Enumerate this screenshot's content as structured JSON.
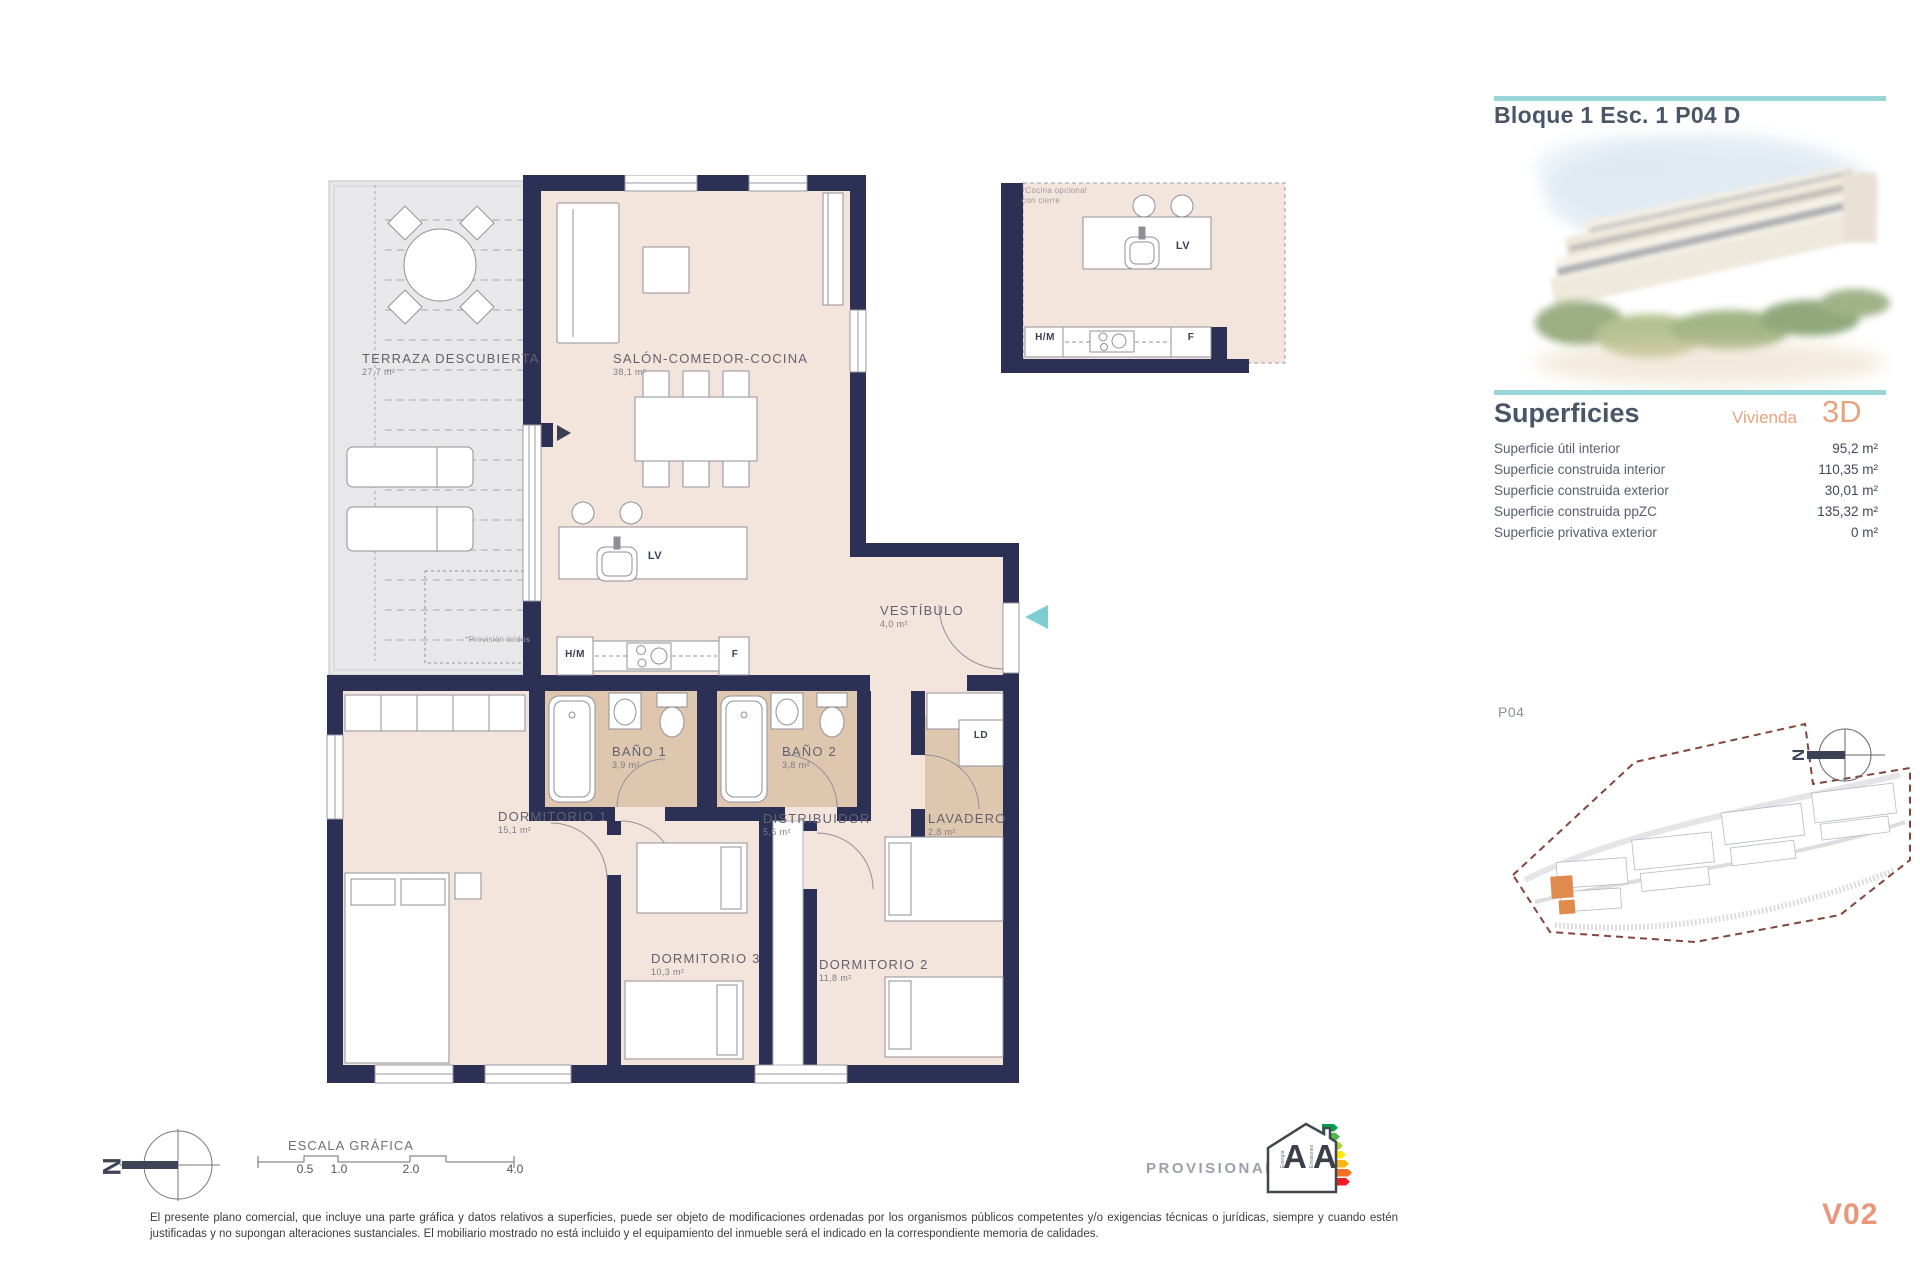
{
  "colors": {
    "wall": "#2b3054",
    "floor": "#f4e5dc",
    "bath_floor": "#dfc7af",
    "terrace": "#e8e8eb",
    "teal_accent": "#9ad6d8",
    "orange_accent": "#e8977c",
    "site_boundary": "#84453b"
  },
  "header": {
    "title": "Bloque 1 Esc. 1 P04 D"
  },
  "superficies": {
    "heading": "Superficies",
    "unit_label": "Vivienda",
    "unit_code": "3D",
    "rows": [
      {
        "label": "Superficie útil interior",
        "value": "95,2 m²"
      },
      {
        "label": "Superficie construida interior",
        "value": "110,35 m²"
      },
      {
        "label": "Superficie construida exterior",
        "value": "30,01 m²"
      },
      {
        "label": "Superficie construida ppZC",
        "value": "135,32 m²"
      },
      {
        "label": "Superficie privativa exterior",
        "value": "0 m²"
      }
    ]
  },
  "floorplan": {
    "rooms": [
      {
        "name": "TERRAZA DESCUBIERTA",
        "area": "27,7 m²"
      },
      {
        "name": "SALÓN-COMEDOR-COCINA",
        "area": "38,1 m²"
      },
      {
        "name": "VESTÍBULO",
        "area": "4,0 m²"
      },
      {
        "name": "BAÑO 1",
        "area": "3,9 m²"
      },
      {
        "name": "BAÑO 2",
        "area": "3,8 m²"
      },
      {
        "name": "DORMITORIO 1",
        "area": "15,1 m²"
      },
      {
        "name": "DISTRIBUIDOR",
        "area": "5,6 m²"
      },
      {
        "name": "LAVADERO",
        "area": "2,8 m²"
      },
      {
        "name": "DORMITORIO 3",
        "area": "10,3 m²"
      },
      {
        "name": "DORMITORIO 2",
        "area": "11,8 m²"
      }
    ],
    "appliances": {
      "lv": "LV",
      "hm": "H/M",
      "f": "F",
      "ld": "LD"
    },
    "terrace_note": "*Previsión toldos",
    "kitchen_note": "*Cocina opcional con cierre"
  },
  "site_plan": {
    "floor_label": "P04"
  },
  "scale_bar": {
    "title": "ESCALA GRÁFICA",
    "ticks": [
      "0.5",
      "1.0",
      "2.0",
      "4.0"
    ]
  },
  "compass": {
    "letter": "N"
  },
  "energy": {
    "status": "PROVISIONAL",
    "letters": [
      "A",
      "A"
    ],
    "axis_labels": [
      "Energía",
      "Emisiones"
    ]
  },
  "footer": {
    "disclaimer": "El presente plano comercial, que incluye una parte gráfica y datos relativos a superficies, puede ser objeto de modificaciones ordenadas por los organismos públicos competentes y/o exigencias técnicas o jurídicas, siempre y cuando estén justificadas y no supongan alteraciones sustanciales. El mobiliario mostrado no está incluido y el equipamiento del inmueble será el indicado en la correspondiente memoria de calidades.",
    "version": "V02"
  }
}
